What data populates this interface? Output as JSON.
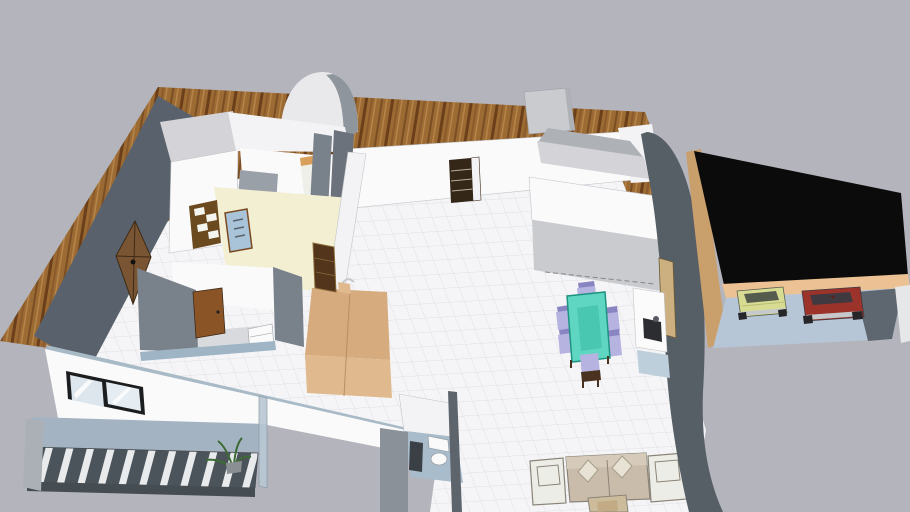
{
  "viewer": {
    "type": "3d-architectural-model-view",
    "background": "#b4b4bd"
  },
  "model": {
    "subject": "single-storey house floor plan with furniture, terrace, balcony and double garage",
    "objects": [
      "wood-deck-terrace",
      "entry-arch",
      "chimney-block",
      "tile-floor",
      "dark-exterior-wall",
      "exterior-wood-door",
      "front-entry-door",
      "bathroom-cream-floor",
      "glass-shower-panel",
      "wall-shelf-unit",
      "bedroom",
      "bedroom-door",
      "kitchen-island",
      "kitchen-hutch",
      "dining-table",
      "dining-chairs",
      "media-console",
      "sofa",
      "armchairs",
      "coffee-table",
      "wc-room",
      "toilet",
      "water-heater",
      "south-wall-window",
      "balcony",
      "balcony-railing",
      "balcony-plant",
      "curved-side-wall",
      "garage",
      "garage-flat-roof",
      "yellow-car",
      "red-car"
    ]
  },
  "palette": {
    "bg": "#b4b4bd",
    "wood_base": "#9c6a33",
    "wood_dark1": "#7a4e24",
    "wood_dark2": "#6b3f1a",
    "wood_light": "#b5854a",
    "wood_mid": "#8a5a2b",
    "tile_base": "#f5f5f7",
    "tile_line": "#dfdfe4",
    "slate_wall": "#59626c",
    "slate_curve": "#565e66",
    "slate_face": "#79818a",
    "slate_light": "#8f959c",
    "wall_white": "#fafafb",
    "wall_soft": "#f3f3f5",
    "wall_top": "#d4d4d8",
    "wall_gray": "#c9cbce",
    "wall_mid": "#aeb1b6",
    "wall_inner": "#9aa0a7",
    "wall_shadow": "#6b727b",
    "wall_edge": "#c2c5c9",
    "cream": "#f2efd2",
    "door_dark": "#352718",
    "door_brown": "#8a5426",
    "door_ext": "#7a5534",
    "door_line": "#3e2a16",
    "door_panel_light": "#b9ad9d",
    "shelf_brown": "#6b4a20",
    "shelf_item": "#f5f5f0",
    "glass_blue": "#a9c3d8",
    "glass_frame": "#7a4a22",
    "counter_tan": "#d6ab7d",
    "counter_tan_light": "#e0ba8e",
    "counter_divide": "#b98f62",
    "hutch_brown": "#52351a",
    "hutch_trim": "#8a6a3a",
    "teal": "#5fd6c2",
    "teal_dark": "#49c7b1",
    "teal_edge": "#1f9381",
    "lavender": "#b6b3e0",
    "lavender_dark": "#8885c2",
    "chair_wood": "#4a3120",
    "sofa_tan": "#cabcab",
    "sofa_tan_light": "#d6cabb",
    "pillow": "#e8e2d5",
    "pillow_edge": "#a79d8a",
    "armchair": "#edede7",
    "sofa_outline": "#8a8478",
    "table_wood": "#cdbc9c",
    "table_wood_dark": "#c2ab84",
    "garage_roof": "#0b0b0c",
    "garage_tan": "#ecc294",
    "garage_tan_dark": "#c99f6b",
    "garage_floor": "#b7c6d6",
    "garage_shadow": "#5e6770",
    "garage_white": "#e6e7e9",
    "car_yellow": "#d8dc92",
    "car_yellow_glass": "#555c4d",
    "car_yellow_line": "#b9bd75",
    "car_red": "#9c332b",
    "car_red_glass": "#403a40",
    "chrome": "#c6c9cc",
    "wheel": "#26262a",
    "balcony_floor": "#a3b3c2",
    "rail_dark": "#4c545b",
    "rail_light": "#e8eaec",
    "rail_base": "#454c52",
    "balcony_cap": "#aab0b6",
    "glass_panel": "#b9c8d4",
    "glass_panel_edge": "#8a99a5",
    "cap_blue": "#a9bac7",
    "wc_floor": "#a9bccb",
    "wc_gray": "#8b9199",
    "wc_wall": "#5d646c",
    "heater": "#3b4046",
    "fixture_white": "#fafafa",
    "fixture_edge": "#99a1a8",
    "window_frame": "#1c1d1f",
    "window_glass": "#dde6ec",
    "window_glass2": "#e6edf2",
    "plant_green": "#3c6b33",
    "pot_gray": "#8a8f94",
    "console_white": "#fbfbfb",
    "console_insert": "#2c2d31",
    "console_base": "#bccfdb",
    "console_trim": "#cdb080",
    "console_trim_edge": "#6b5a34",
    "bed_head": "#d9a05b",
    "bed_white": "#efefe9",
    "arch_white": "#e9e9ec",
    "dash_line": "#82878d",
    "room_floor_gray": "#d8dadd",
    "step_blue": "#9fb4c4"
  }
}
